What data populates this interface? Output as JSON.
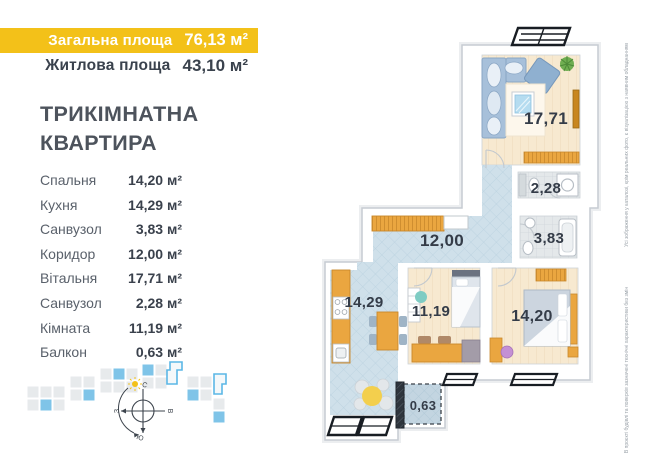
{
  "banner": {
    "total_label": "Загальна площа",
    "total_value": "76,13 м²",
    "living_label": "Житлова площа",
    "living_value": "43,10 м²"
  },
  "title": {
    "line1": "ТРИКІМНАТНА",
    "line2": "КВАРТИРА"
  },
  "room_list": [
    {
      "name": "Спальня",
      "area": "14,20 м²"
    },
    {
      "name": "Кухня",
      "area": "14,29 м²"
    },
    {
      "name": "Санвузол",
      "area": "3,83 м²"
    },
    {
      "name": "Коридор",
      "area": "12,00 м²"
    },
    {
      "name": "Вітальня",
      "area": "17,71 м²"
    },
    {
      "name": "Санвузол",
      "area": "2,28 м²"
    },
    {
      "name": "Кімната",
      "area": "11,19 м²"
    },
    {
      "name": "Балкон",
      "area": "0,63 м²"
    }
  ],
  "plan_labels": {
    "living": "17,71",
    "bath_top": "2,28",
    "corridor": "12,00",
    "bath_mid": "3,83",
    "kitchen": "14,29",
    "room": "11,19",
    "bedroom": "14,20",
    "balcony": "0,63"
  },
  "compass": {
    "n": "С",
    "e": "В",
    "s": "Ю",
    "w": "З"
  },
  "notes": {
    "upper": "Усі зображення у каталозі, крім реальних фото, є візуалізацією з наявним обладнанням",
    "lower": "В проєкті будівлі та поверхів зазначені технічні характеристики без змін"
  },
  "colors": {
    "accent_yellow": "#F3C119",
    "plan_blue": "#CFE0EA",
    "plan_beige": "#F7E9D0",
    "plan_gray": "#E4E8EA",
    "furniture_orange": "#EAA640",
    "dark_text": "#3A414C"
  }
}
